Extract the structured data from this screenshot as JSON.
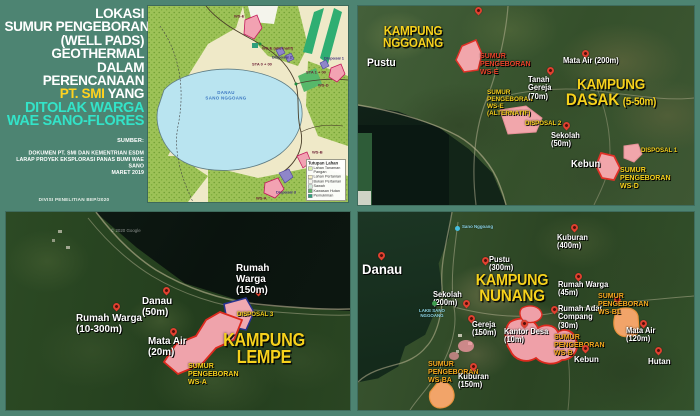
{
  "colors": {
    "background_teal": "#4d8472",
    "title_yellow": "#ffd21f",
    "title_cyan": "#33e3c8",
    "village_yellow": "#f6d11c",
    "well_red": "#e8432a",
    "well_orange": "#f5a91e",
    "pad_pink": "#f1a6ab",
    "pad_border_red": "#de2d22",
    "pin_red": "#e04130"
  },
  "title_panel": {
    "lines_white": [
      "LOKASI",
      "SUMUR PENGEBORAN",
      "(WELL PADS)",
      "GEOTHERMAL",
      "DALAM",
      "PERENCANAAN"
    ],
    "accent_company": "PT. SMI",
    "accent_tail": " YANG",
    "lines_cyan": [
      "DITOLAK WARGA",
      "WAE SANO-FLORES"
    ],
    "source_label": "SUMBER:",
    "source_lines": [
      "DOKUMEN PT. SMI DAN KEMENTRIAN ESDM",
      "LARAP PROYEK EKSPLORASI PANAS BUMI WAE SANO",
      "MARET 2019"
    ],
    "credit": "DIVISI PENELITIAN BEP/2020"
  },
  "overview_map": {
    "lake_name_line1": "DANAU",
    "lake_name_line2": "SANO NGGOANG",
    "tags": [
      "WS-E",
      "WS-E (alternatif)",
      "Disposal 2",
      "STA 0 + 00",
      "STA 1 + 00",
      "Disposal 1",
      "WS-D",
      "Disposal 3",
      "WS-A",
      "WS-B"
    ],
    "legend": {
      "title": "Tutupan Lahan",
      "items": [
        {
          "label": "Lahan Tanaman Pangan",
          "color": "#d7eda5"
        },
        {
          "label": "Lahan Pertanian",
          "color": "#f6f1c6"
        },
        {
          "label": "Bukan Pertanian",
          "color": "#f4f4ec"
        },
        {
          "label": "Sawah",
          "color": "#cde9d8"
        },
        {
          "label": "Kawasan Hutan",
          "color": "#5cb468"
        },
        {
          "label": "Pemukiman",
          "color": "#2f9e7c"
        }
      ]
    }
  },
  "map_dasak": {
    "village_nggoang_line1": "KAMPUNG",
    "village_nggoang_line2": "NGGOANG",
    "village_dasak_line1": "KAMPUNG",
    "village_dasak_line2": "DASAK",
    "village_dasak_range": "(5-50m)",
    "well_ws_e": "SUMUR PENGEBORAN WS-E",
    "well_ws_e_alt": "SUMUR PENGEBORAN WS-E (ALTERNATIF)",
    "well_ws_d": "SUMUR PENGEBORAN WS-D",
    "disposal_2": "DISPOSAL 2",
    "disposal_1": "DISPOSAL 1",
    "poi_pustu": "Pustu",
    "poi_mata_air": "Mata Air (200m)",
    "poi_tanah_gereja": "Tanah Gereja (70m)",
    "poi_sekolah": "Sekolah (50m)",
    "poi_kebun": "Kebun"
  },
  "map_lempe": {
    "village_line1": "KAMPUNG",
    "village_line2": "LEMPE",
    "well_ws_a": "SUMUR PENGEBORAN WS-A",
    "disposal_3": "DISPOSAL 3",
    "poi_danau": "Danau (50m)",
    "poi_rumah_warga_150": "Rumah Warga (150m)",
    "poi_rumah_warga_range": "Rumah Warga (10-300m)",
    "poi_mata_air": "Mata Air (20m)",
    "watermark": "© 2020 Google"
  },
  "map_nunang": {
    "village_line1": "KAMPUNG",
    "village_line2": "NUNANG",
    "poi_danau": "Danau",
    "gmaps_lake_label": "Sano Nggoang",
    "gmaps_lakeside_label": "LAKE SANO NGGOANG",
    "poi_pustu": "Pustu (300m)",
    "poi_kuburan_400": "Kuburan (400m)",
    "poi_sekolah": "Sekolah (200m)",
    "poi_gereja": "Gereja (150m)",
    "poi_kantor_desa": "Kantor Desa (10m)",
    "poi_rumah_adat": "Rumah Adat, Compang (30m)",
    "poi_rumah_warga_45": "Rumah Warga (45m)",
    "poi_mata_air": "Mata Air (120m)",
    "poi_kebun": "Kebun",
    "poi_hutan": "Hutan",
    "poi_kuburan_150": "Kuburan (150m)",
    "well_ws_b": "SUMUR PENGEBORAN WS-B",
    "well_ws_b1": "SUMUR PENGEBORAN WS-B1",
    "well_ws_ba": "SUMUR PENGEBORAN WS-BA"
  }
}
